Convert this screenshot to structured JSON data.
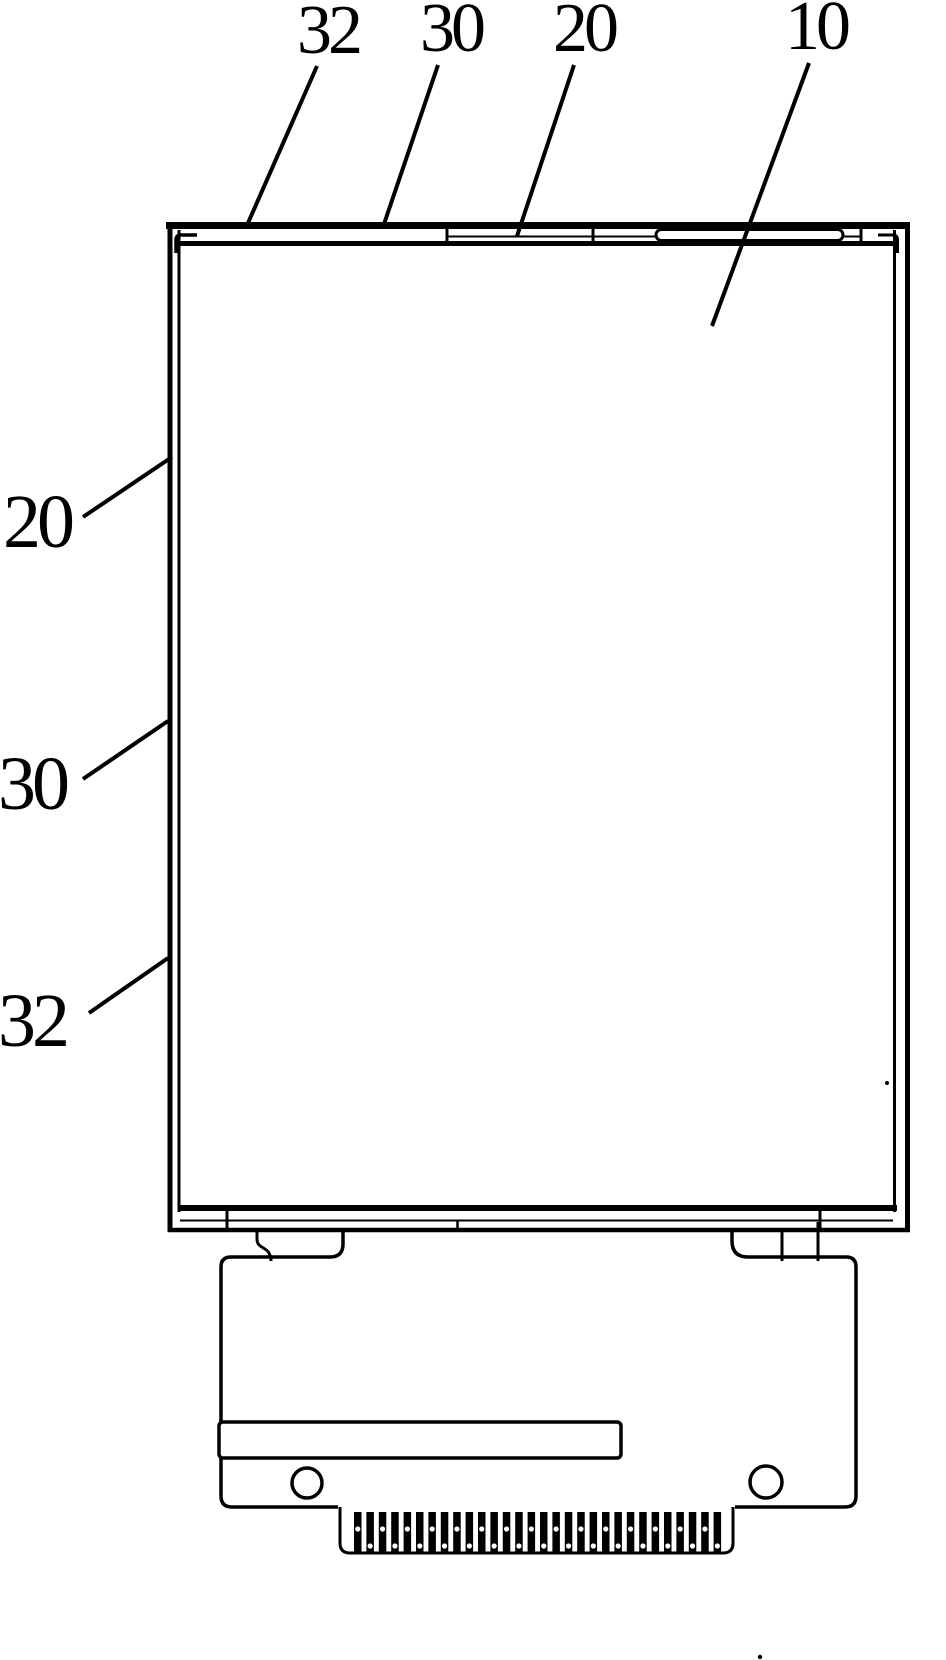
{
  "figure": {
    "kind": "patent-line-drawing",
    "subject": "display-module-front-view",
    "background_color": "#ffffff",
    "line_color": "#000000"
  },
  "reference_labels": {
    "top": [
      {
        "text": "32"
      },
      {
        "text": "30"
      },
      {
        "text": "20"
      },
      {
        "text": "10"
      }
    ],
    "left": [
      {
        "text": "20"
      },
      {
        "text": "30"
      },
      {
        "text": "32"
      }
    ]
  },
  "connector": {
    "pin_count": 30,
    "mounting_hole_count": 2
  }
}
